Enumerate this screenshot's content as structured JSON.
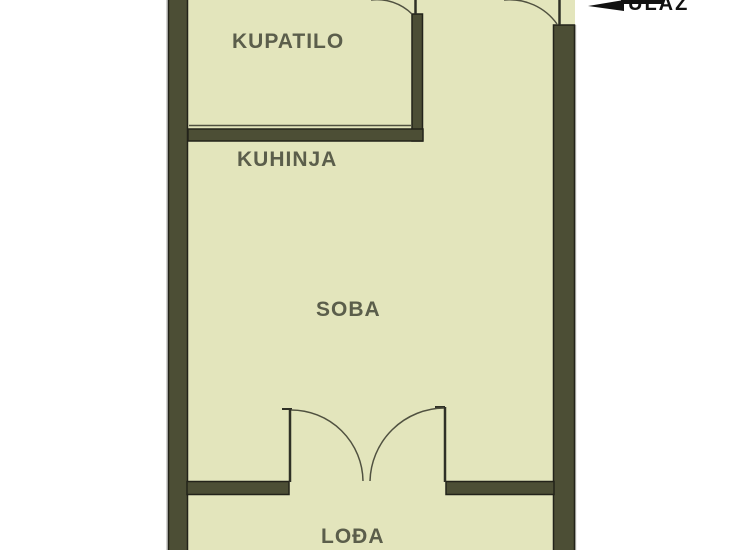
{
  "title": "Apartment floor plan",
  "colors": {
    "background": "#ffffff",
    "interior": "#e3e5bc",
    "wall": "#4c4e35",
    "wall_edge": "#23231a",
    "wall_outer_edge": "#c6c6c2",
    "thin_line": "#505140",
    "door_leaf": "#2f3026",
    "label": "#5b5e4b",
    "entrance": "#111111"
  },
  "rooms": [
    {
      "id": "kupatilo",
      "label": "KUPATILO"
    },
    {
      "id": "kuhinja",
      "label": "KUHINJA"
    },
    {
      "id": "soba",
      "label": "SOBA"
    },
    {
      "id": "lodja",
      "label": "LOĐA"
    }
  ],
  "entrance": {
    "label": "ULAZ",
    "icon": "left-arrow-icon"
  }
}
